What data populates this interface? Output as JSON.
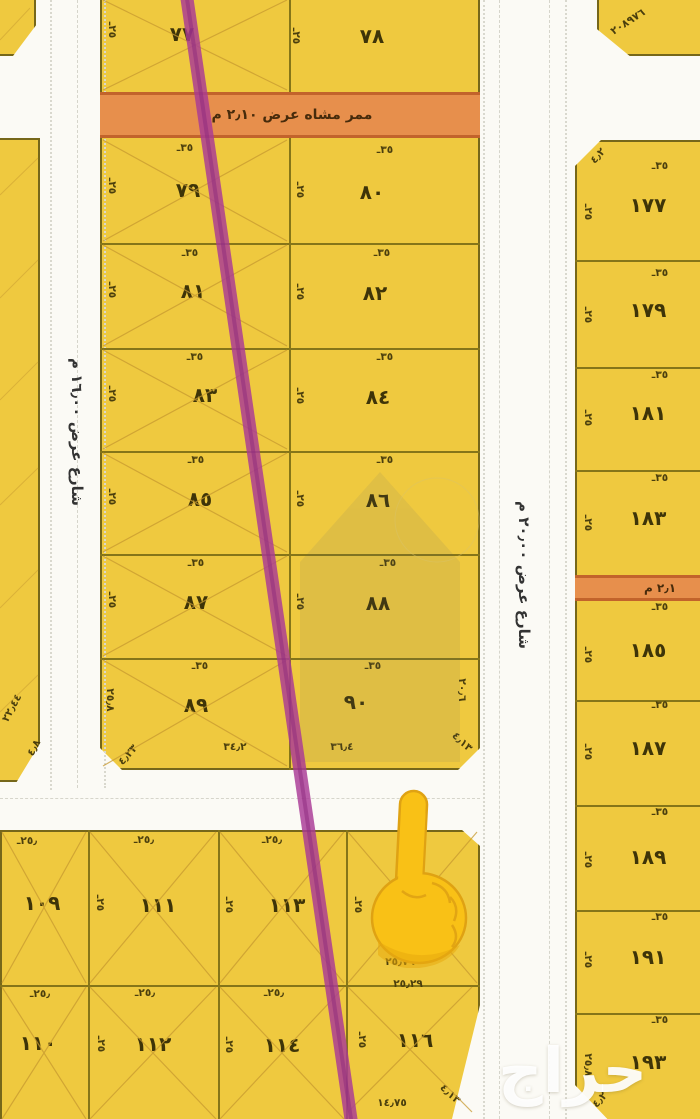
{
  "streets": {
    "left_label": "شارع عرض ١٦٫٠٠ م",
    "right_label": "شارع عرض ٢٠٫٠٠ م"
  },
  "walkways": {
    "upper_label": "ممر مشاه عرض ٢٫١٠ م",
    "right_label": "٢٫١ م"
  },
  "dims": {
    "w35": "٣٥ـ",
    "d25": "٢٥ـ",
    "w25": "٢٥٫ـ"
  },
  "parcels": {
    "p77": "٧٧",
    "p78": "٧٨",
    "p79": "٧٩",
    "p80": "٨٠",
    "p81": "٨١",
    "p82": "٨٢",
    "p83": "٨٣",
    "p84": "٨٤",
    "p85": "٨٥",
    "p86": "٨٦",
    "p87": "٨٧",
    "p88": "٨٨",
    "p89": "٨٩",
    "p90": "٩٠",
    "p109": "١٠٩",
    "p110": "١١٠",
    "p111": "١١١",
    "p112": "١١٢",
    "p113": "١١٣",
    "p114": "١١٤",
    "p116": "١١٦",
    "p177": "١٧٧",
    "p179": "١٧٩",
    "p181": "١٨١",
    "p183": "١٨٣",
    "p185": "١٨٥",
    "p187": "١٨٧",
    "p189": "١٨٩",
    "p191": "١٩١",
    "p193": "١٩٣"
  },
  "annotations": {
    "top_right_corner": "٢٠٨٩٧٦",
    "p89_side": "٢٥٫٨",
    "p89_bottom": "٣٤٫٢",
    "p89_corner": "٤٫٢٣",
    "p90_side": "٢٠٫٦",
    "p90_bottom": "٣٦٫٤",
    "p90_corner": "٤٫١٣",
    "p116_top_a": "٢٥٫٧٦",
    "p116_top_b": "٢٥٫٢٩",
    "p116_bottom": "١٤٫٧٥",
    "p116_corner": "٤٫١٣",
    "p177_corner": "٤٫٢",
    "p193_side": "٢٥٫٨",
    "p193_corner": "٤٫٢",
    "left_strip_a": "٢٢٫٤٤",
    "left_strip_b": "٤٫٨"
  },
  "watermark": {
    "brand": "حراج"
  },
  "icons": {
    "pointer": "pointing-up-finger"
  },
  "colors": {
    "parcel": "#EFC93F",
    "walkway": "#E78F4C",
    "boundary_line": "#A93897",
    "border": "#76671A"
  }
}
